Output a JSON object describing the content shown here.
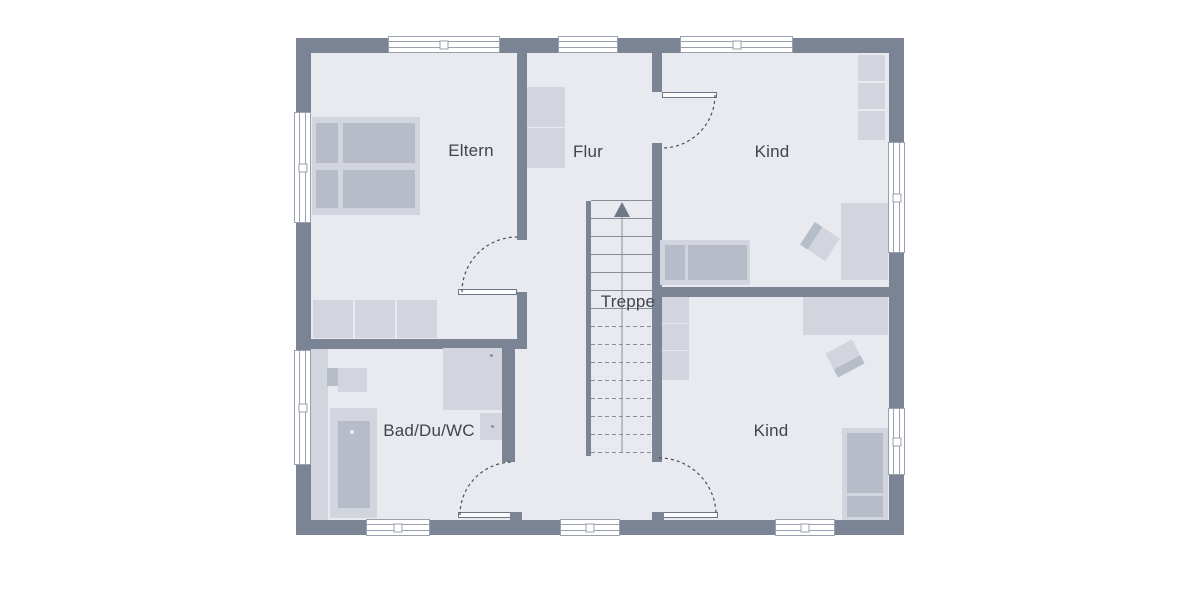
{
  "floorplan": {
    "type": "residential-upper-floor-plan",
    "rooms": [
      {
        "id": "eltern",
        "label": "Eltern"
      },
      {
        "id": "flur",
        "label": "Flur"
      },
      {
        "id": "kind-top",
        "label": "Kind"
      },
      {
        "id": "treppe",
        "label": "Treppe"
      },
      {
        "id": "bad",
        "label": "Bad/Du/WC"
      },
      {
        "id": "kind-bottom",
        "label": "Kind"
      }
    ],
    "stairs": {
      "label": "Treppe",
      "direction": "up"
    },
    "colors": {
      "background": "#ffffff",
      "wall": "#7b8495",
      "floor": "#e9eaef",
      "furniture_light": "#d2d5dd",
      "furniture_dark": "#b6bcc8",
      "window_line": "#99a0ae",
      "door_line": "#4a4f5a",
      "stair_line": "#858d9b",
      "text": "#3e4450"
    }
  }
}
